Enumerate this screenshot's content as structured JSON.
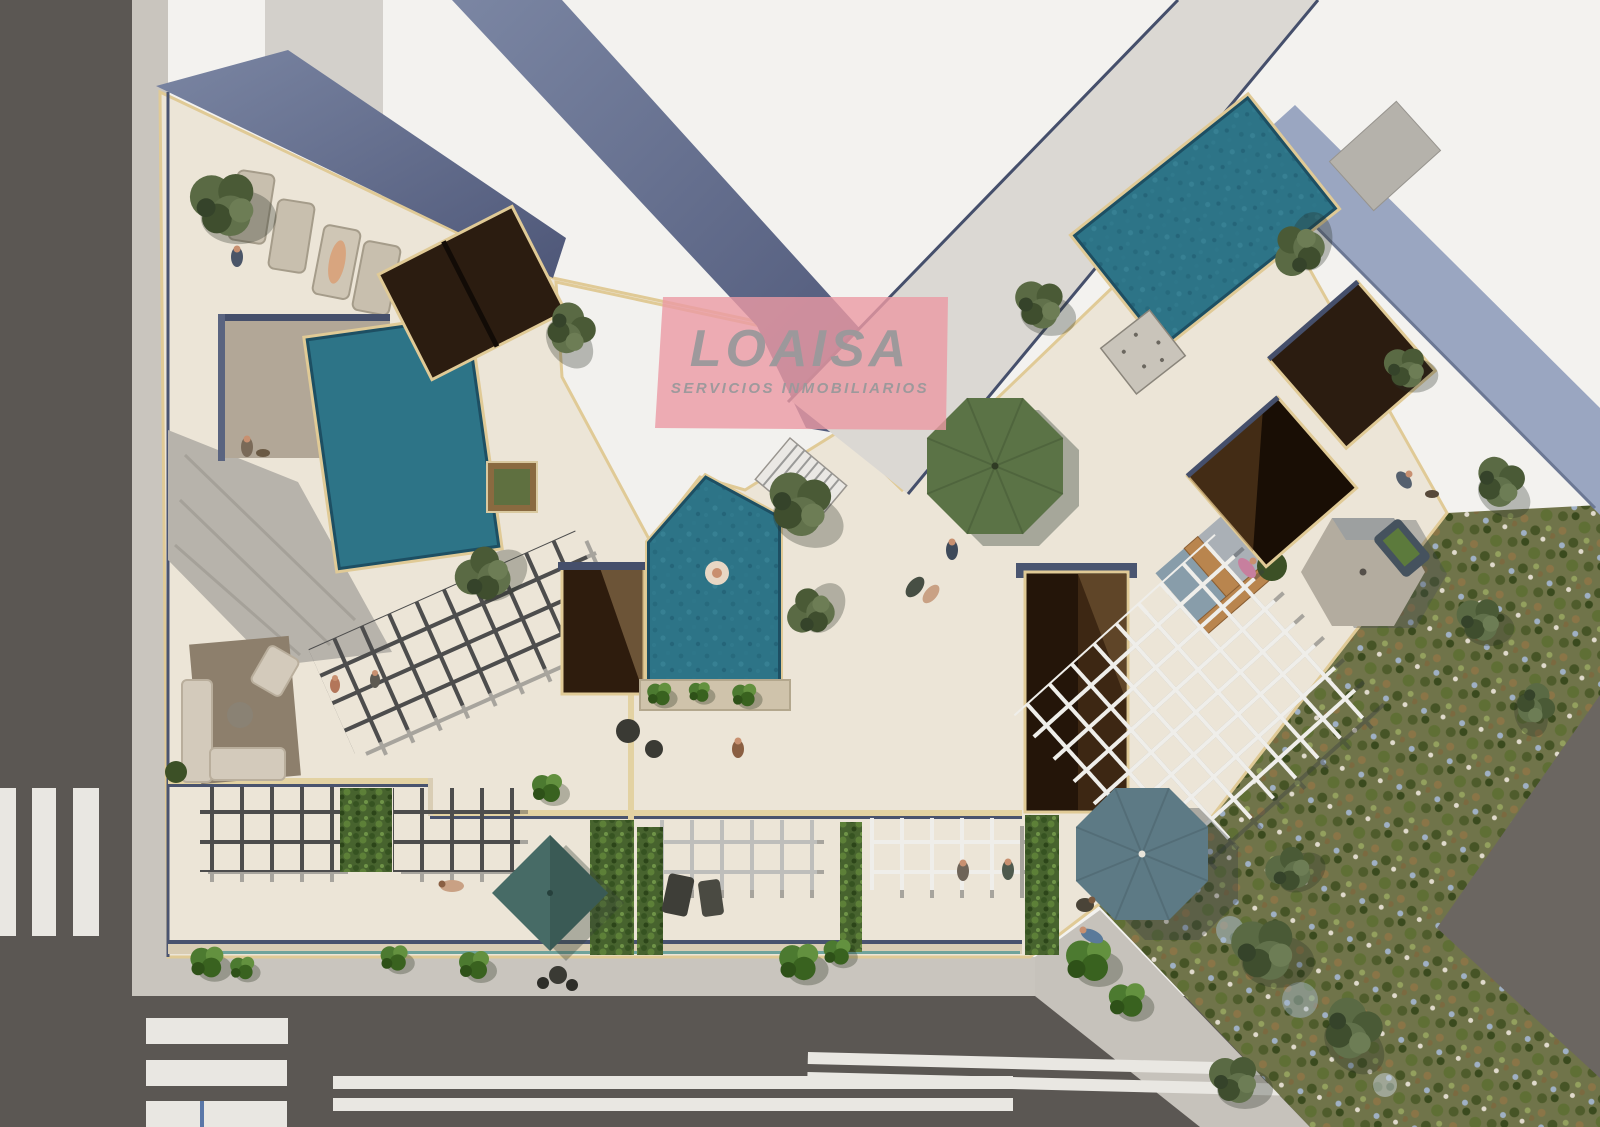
{
  "watermark": {
    "title": "LOAISA",
    "subtitle": "SERVICIOS INMOBILIARIOS"
  },
  "palette": {
    "road": "#5b5753",
    "road_right": "#6b6661",
    "sidewalk": "#c9c5be",
    "crosswalk": "#e9e7e2",
    "terrace": "#ece5d7",
    "trim_yellow": "#e0ca96",
    "wall_navy": "#4a5470",
    "roof_white": "#f3f2ef",
    "roof_gray": "#dbd8d3",
    "roof_blue": "#9aa6c1",
    "pool_teal": "#2d7487",
    "pool_edge": "#1d4f63",
    "deck_brown": "#2b1c10",
    "garden_base": "#70744a",
    "umbrella_green": "#5b7346",
    "umbrella_blue": "#5d7a85",
    "umbrella_gray": "#b3ac9f",
    "umbrella_teal": "#476b66",
    "watermark_pink": "#eb9aa4",
    "logo_gray": "#9a999b"
  },
  "scene": {
    "type": "aerial-3d-architectural-render",
    "elements": [
      "asphalt-road-left",
      "asphalt-road-bottom",
      "asphalt-road-diagonal",
      "pedestrian-crosswalk-left",
      "pedestrian-crosswalk-bottom",
      "lane-markings",
      "sidewalks",
      "rooftop-terrace",
      "swimming-pool-left",
      "swimming-pool-pentagon",
      "swimming-pool-right",
      "sun-loungers",
      "shade-canopy",
      "wood-deck-panels",
      "patio-voids",
      "pergola-grids",
      "parasol-green",
      "parasol-blue-gray",
      "parasol-beige",
      "parasol-teal-square",
      "outdoor-sofa-set",
      "wooden-bench-corner",
      "stairs",
      "olive-trees",
      "hedge-planters",
      "wild-garden",
      "residents-and-pets"
    ]
  }
}
